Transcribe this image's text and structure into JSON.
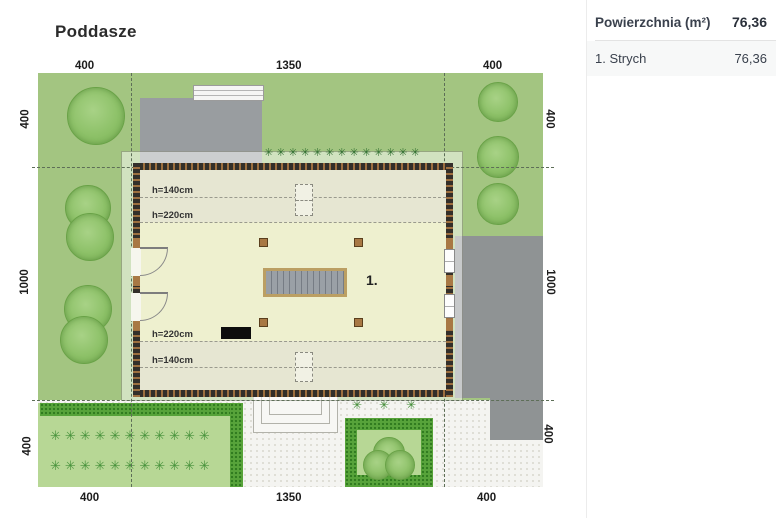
{
  "title": "Poddasze",
  "panel": {
    "header": {
      "label": "Powierzchnia (m²)",
      "value": "76,36"
    },
    "rows": [
      {
        "label": "1. Strych",
        "value": "76,36"
      }
    ]
  },
  "plan": {
    "room_label": "1.",
    "height_labels": {
      "top_140": "h=140cm",
      "top_220": "h=220cm",
      "bottom_220": "h=220cm",
      "bottom_140": "h=140cm"
    },
    "dimensions": {
      "top": [
        "400",
        "1350",
        "400"
      ],
      "bottom": [
        "400",
        "1350",
        "400"
      ],
      "left": [
        "400",
        "1000",
        "400"
      ],
      "right": [
        "400",
        "1000",
        "400"
      ]
    }
  },
  "decor": {
    "grass_row": "✳✳✳✳✳✳✳✳✳✳✳✳✳",
    "plant_row_1": "✳✳✳✳✳✳✳✳✳✳✳",
    "plant_row_2": "✳✳✳✳✳✳✳✳✳✳✳",
    "shrub_row": "✳✳✳"
  },
  "colors": {
    "lawn": "#a3c581",
    "hedge": "#57a33a",
    "gray_paving": "#8f9394",
    "white_paving": "#f4f4f1",
    "room_fill": "#eef0cf",
    "wall_dark": "#332f2a",
    "wall_hatch": "#9d6f3f",
    "stairs_frame": "#bb9f63",
    "panel_row_bg": "#f7f8f8"
  }
}
